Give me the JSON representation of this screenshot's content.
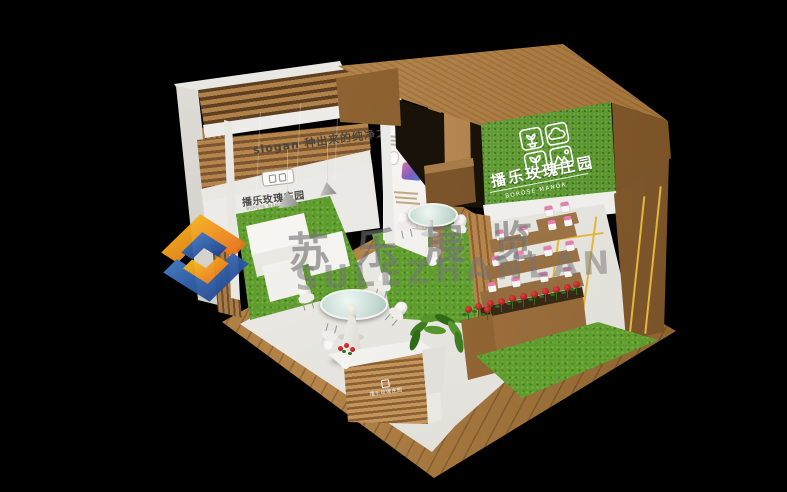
{
  "scene": {
    "description": "3D render of an exhibition booth on black background",
    "background": "#000000"
  },
  "booth": {
    "canopy_sign": {
      "brand_cn": "播乐玫瑰庄园",
      "brand_en": "BOROSE MANOR",
      "panel_color": "#5a9a29",
      "text_color": "#ffffff",
      "icon_cells": [
        "potted-plant-icon",
        "cloud-icon",
        "sprout-icon",
        "mountain-icon"
      ]
    },
    "slogan_wall": {
      "text": "slogan 种出来的纯净之美"
    },
    "interior_wall_logo": {
      "text_cn": "播乐玫瑰庄园",
      "text_en": "BOROSE MANOR"
    },
    "reception_desk": {
      "logo_text": "播乐玫瑰庄园"
    },
    "colors": {
      "wood": "#b1854e",
      "wood_dark": "#7a5530",
      "grass": "#5f9e2c",
      "sign_green": "#5a9a29",
      "wall_white": "#f2f1ed",
      "accent_yellow": "#e5b63c",
      "rose_red": "#c01818"
    }
  },
  "watermark": {
    "text_cn": "苏乐展览",
    "text_en": "SULEZHANLAN",
    "logo_colors": {
      "blue": "#1d3f8a",
      "light_blue": "#4a84cc",
      "yellow": "#f9c81f",
      "orange": "#e8661c"
    }
  }
}
